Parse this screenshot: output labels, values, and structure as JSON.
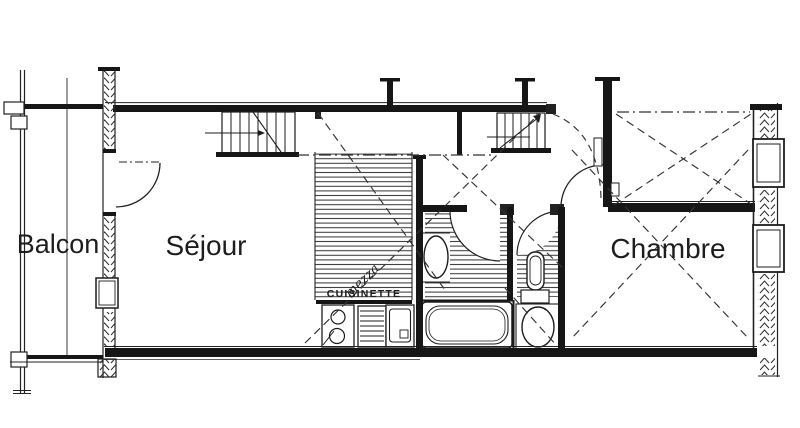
{
  "labels": {
    "balcony": "Balcon",
    "living_room": "Séjour",
    "bedroom": "Chambre",
    "kitchenette": "CUISINETTE",
    "mezzanine_note": "mezza"
  },
  "colors": {
    "ink": "#1a1a1a",
    "paper": "#ffffff",
    "hatch": "#3a3a3a"
  }
}
